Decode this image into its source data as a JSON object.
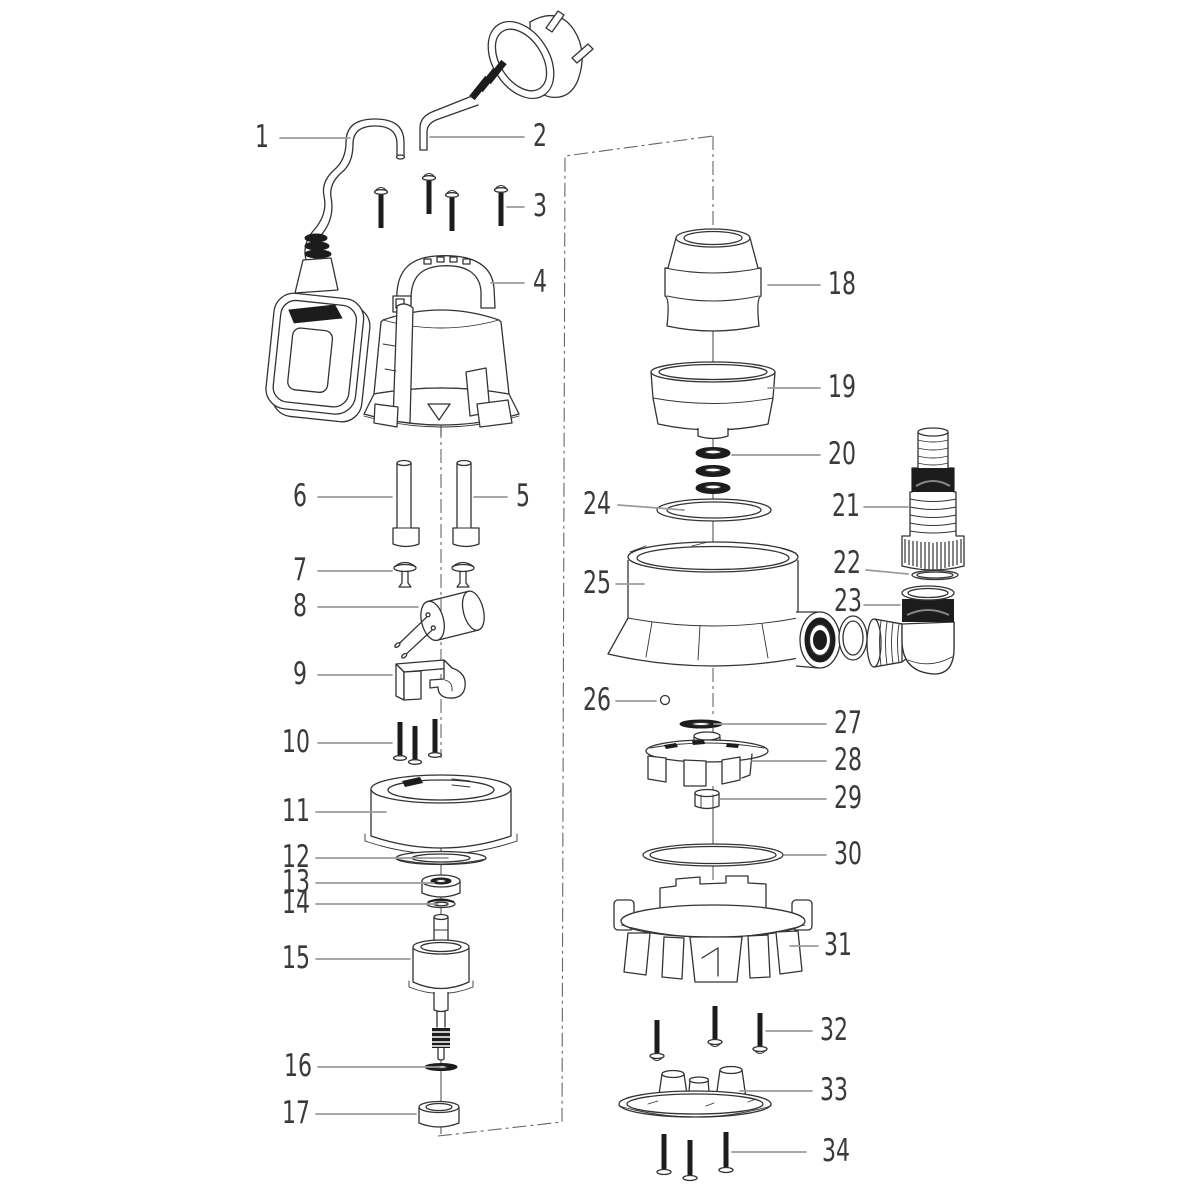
{
  "diagram": {
    "callouts": [
      "1",
      "2",
      "3",
      "4",
      "5",
      "6",
      "7",
      "8",
      "9",
      "10",
      "11",
      "12",
      "13",
      "14",
      "15",
      "16",
      "17",
      "18",
      "19",
      "20",
      "21",
      "22",
      "23",
      "24",
      "25",
      "26",
      "27",
      "28",
      "29",
      "30",
      "31",
      "32",
      "33",
      "34"
    ]
  },
  "colors": {
    "line": "#333333",
    "dark_fill": "#1c1c1c",
    "leader": "#9b9b9b",
    "background": "#ffffff"
  }
}
